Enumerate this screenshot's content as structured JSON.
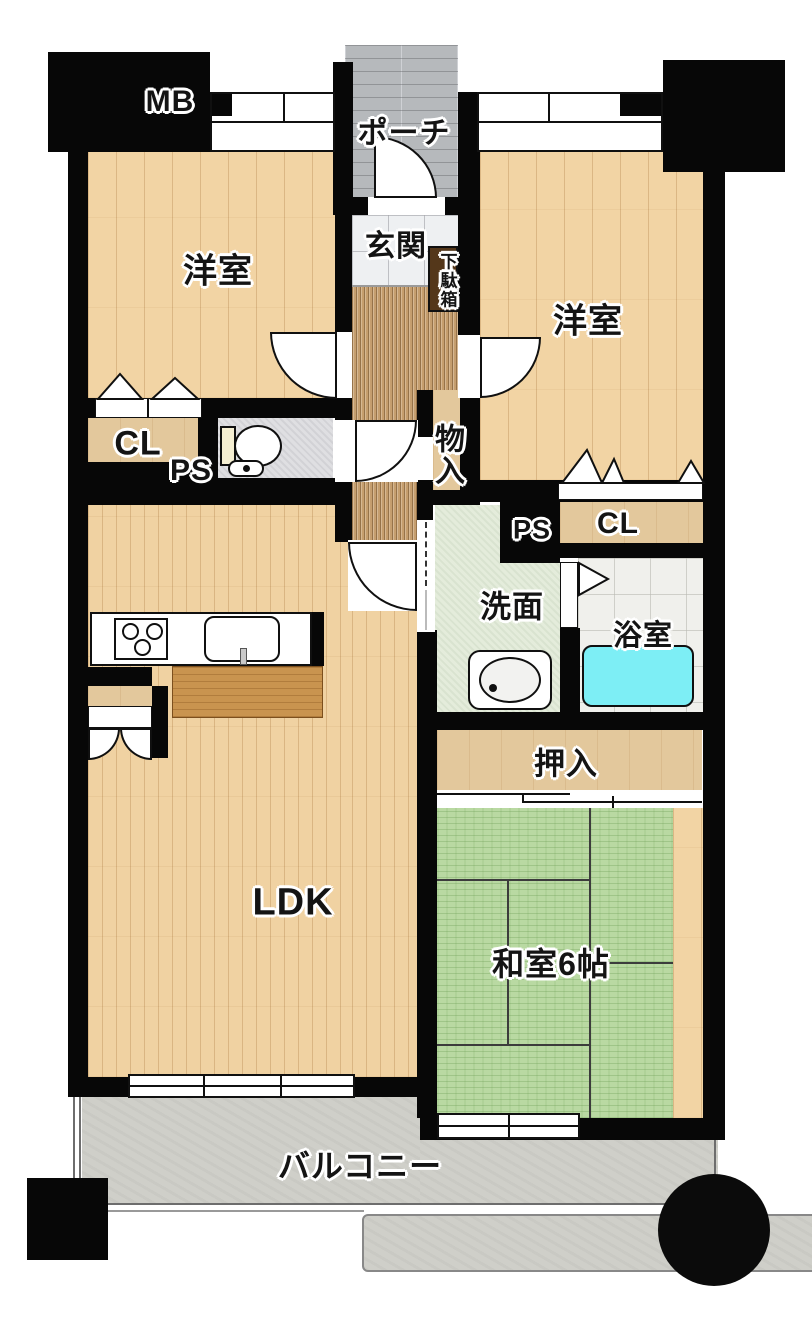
{
  "labels": {
    "mb": "MB",
    "porch": "ポーチ",
    "entrance": "玄関",
    "shoe_cabinet": "下駄箱",
    "western_room_left": "洋室",
    "western_room_right": "洋室",
    "closet_left": "CL",
    "pipe_space_left": "PS",
    "storage": "物入",
    "pipe_space_right": "PS",
    "closet_right": "CL",
    "washroom": "洗面",
    "bathroom": "浴室",
    "futon_closet": "押入",
    "ldk": "LDK",
    "japanese_room": "和室6帖",
    "balcony": "バルコニー"
  },
  "colors": {
    "wall": "#070707",
    "wood_floor": "#f2d4a4",
    "closet_floor": "#e3c89c",
    "hall_carpet": "#c59e6e",
    "entrance_tile": "#eef0f2",
    "porch_tile": "#b6b9bc",
    "washroom_floor": "#e4ecdb",
    "bath_floor": "#f0f0ec",
    "tatami": "#b9d9a2",
    "bathtub": "#7deef5",
    "balcony_floor": "#cfcfc9",
    "island_counter": "#c9944f"
  }
}
